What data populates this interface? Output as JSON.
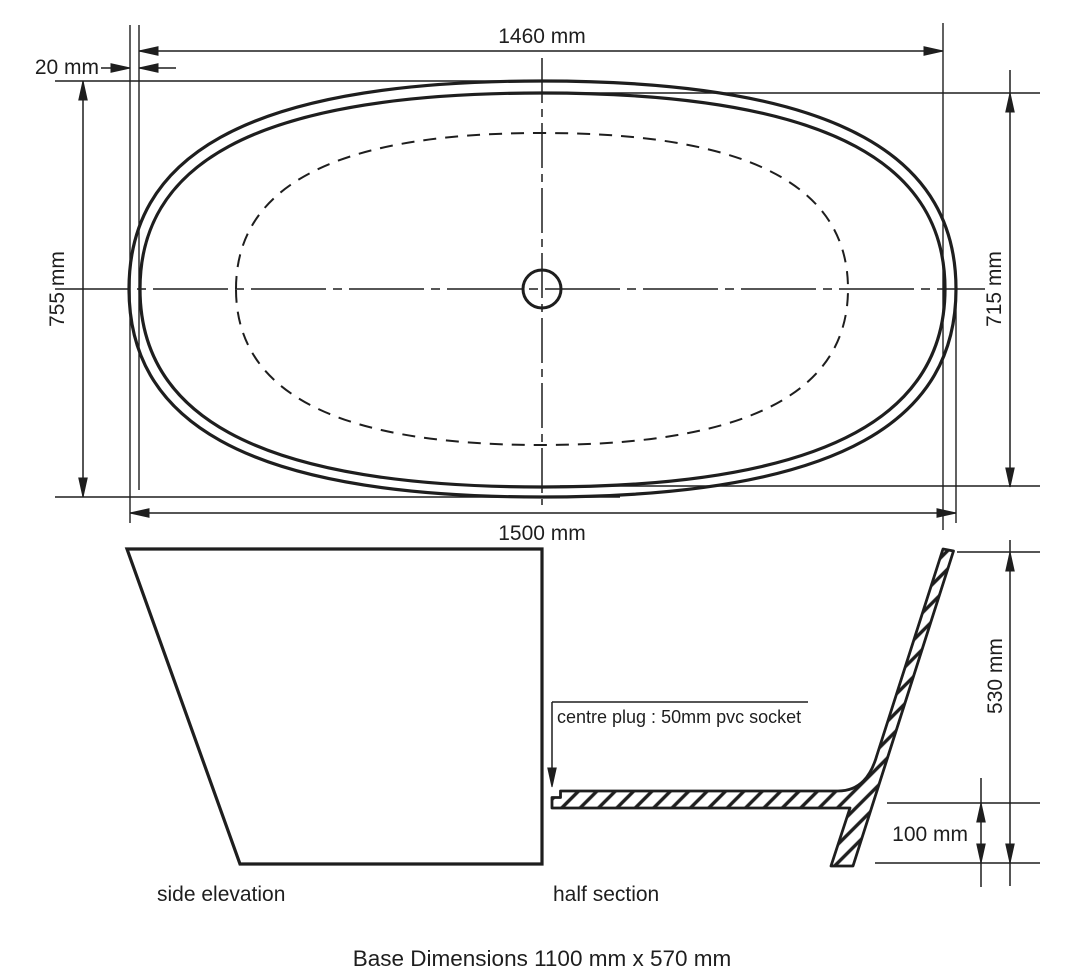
{
  "diagram": {
    "title": "Bath technical drawing",
    "plan_view": {
      "dim_inner_length": "1460 mm",
      "dim_rim_offset": "20 mm",
      "dim_outer_width": "755 mm",
      "dim_inner_width": "715 mm",
      "dim_outer_length": "1500 mm"
    },
    "side_elevation": {
      "label": "side elevation"
    },
    "half_section": {
      "label": "half section",
      "plug_note": "centre plug : 50mm pvc socket",
      "dim_height": "530 mm",
      "dim_base_height": "100 mm"
    },
    "footer": {
      "base_dimensions": "Base Dimensions 1100 mm x 570 mm"
    },
    "colors": {
      "line": "#1e1e1e",
      "background": "#ffffff"
    }
  }
}
